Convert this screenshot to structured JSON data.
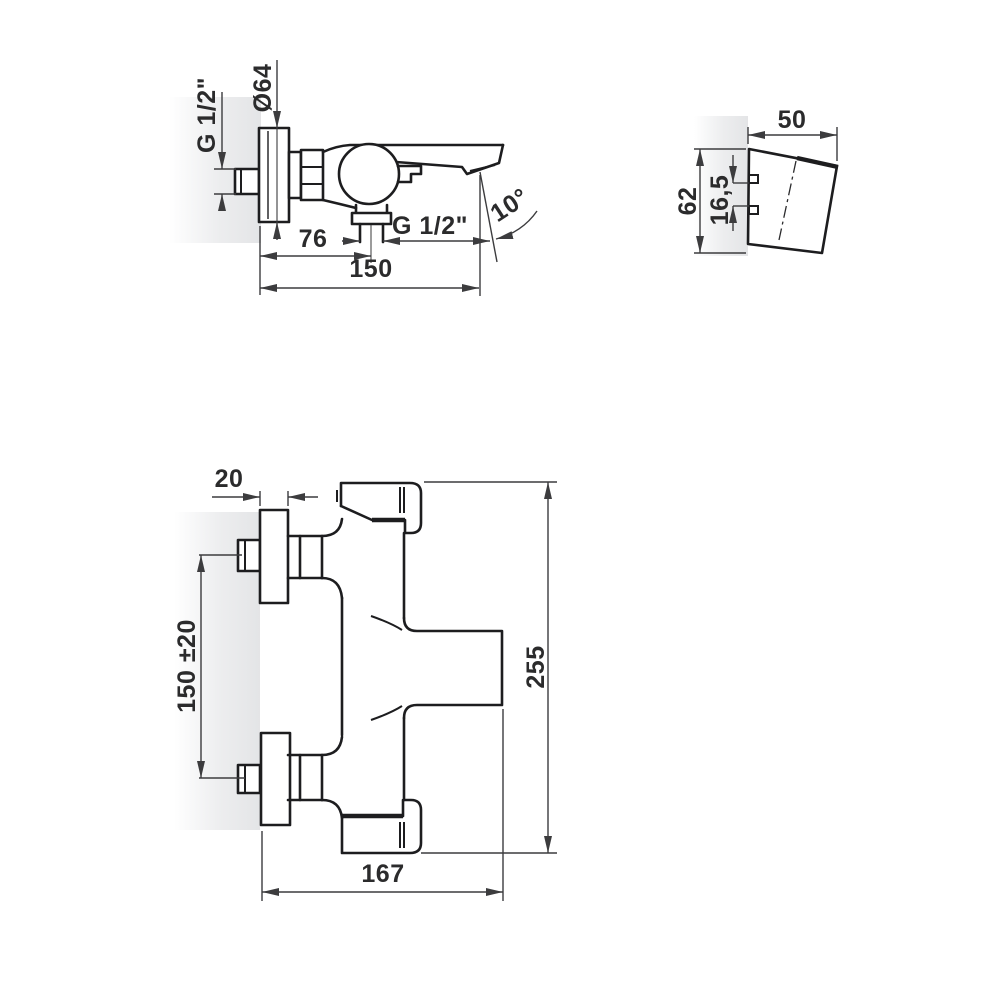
{
  "drawing": {
    "side_view": {
      "wall_thread": "G 1/2\"",
      "flange_diameter": "Ø64",
      "outlet_offset": "76",
      "total_length": "150",
      "outlet_thread": "G 1/2\"",
      "spout_angle": "10°"
    },
    "holder_view": {
      "width": "50",
      "height": "62",
      "pin_spacing": "16,5"
    },
    "front_view": {
      "flange_depth": "20",
      "connection_spacing": "150 ±20",
      "total_height": "255",
      "total_width": "167"
    },
    "colors": {
      "outline": "#1d1d1f",
      "dimension": "#3c3c3e",
      "text": "#2b2b2c",
      "wall_shade": "#e6e7e9",
      "background": "#ffffff"
    }
  }
}
